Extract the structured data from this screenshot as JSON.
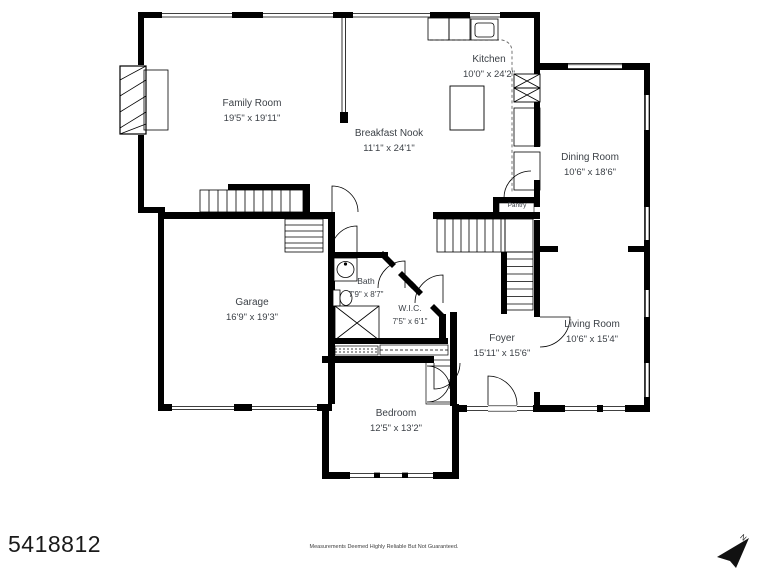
{
  "meta": {
    "listing_id": "5418812",
    "disclaimer": "Measurements Deemed Highly Reliable But Not Guaranteed.",
    "compass": {
      "label": "N"
    },
    "colors": {
      "wall": "#000000",
      "label_text": "#3c4147",
      "background": "#ffffff"
    }
  },
  "rooms": [
    {
      "name": "Family Room",
      "dims": "19'5\" x 19'11\""
    },
    {
      "name": "Kitchen",
      "dims": "10'0\" x 24'2\""
    },
    {
      "name": "Breakfast Nook",
      "dims": "11'1\" x 24'1\""
    },
    {
      "name": "Dining Room",
      "dims": "10'6\" x 18'6\""
    },
    {
      "name": "Pantry",
      "dims": ""
    },
    {
      "name": "Garage",
      "dims": "16'9\" x 19'3\""
    },
    {
      "name": "Bath",
      "dims": "7'9\" x 8'7\""
    },
    {
      "name": "W.I.C.",
      "dims": "7'5\" x 6'1\""
    },
    {
      "name": "Foyer",
      "dims": "15'11\" x 15'6\""
    },
    {
      "name": "Living Room",
      "dims": "10'6\" x 15'4\""
    },
    {
      "name": "Bedroom",
      "dims": "12'5\" x 13'2\""
    }
  ]
}
